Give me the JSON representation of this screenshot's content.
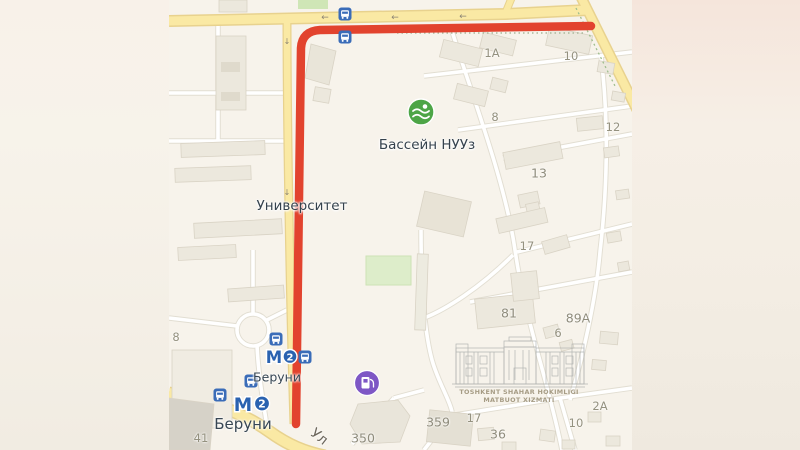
{
  "meta": {
    "description": "Yandex-style city map screenshot with a red route highlighted, blurred letterbox margins",
    "city_area": "Beruniy metro / University district, Tashkent"
  },
  "map": {
    "labels": {
      "pool": "Бассейн НУУз",
      "university": "Университет",
      "metro_upper": "Беруни",
      "metro_lower": "Беруни",
      "street": "Ул"
    },
    "metro": {
      "letter": "М",
      "line": "2"
    },
    "house_numbers": [
      "1А",
      "10",
      "8",
      "12",
      "13",
      "17",
      "81",
      "89А",
      "6",
      "8",
      "41",
      "350",
      "359",
      "17",
      "36",
      "2А",
      "10"
    ],
    "arrows": {
      "left": "←",
      "down": "↓"
    },
    "watermark": {
      "line1": "TOSHKENT SHAHAR HOKIMLIGI",
      "line2": "MATBUOT XIZMATI"
    },
    "icons": {
      "bus_stop": "bus-stop-icon",
      "metro": "metro-icon",
      "pool": "pool-icon",
      "fuel": "fuel-station-icon"
    },
    "colors": {
      "route": "#e2432e",
      "main_road": "#fae9a4",
      "road_casing": "#e8d28e",
      "metro_blue": "#2a62b0",
      "bus_blue": "#3a6cb8",
      "pool_green": "#4da546",
      "fuel_purple": "#7e57c5",
      "land": "#f7f3eb"
    }
  }
}
